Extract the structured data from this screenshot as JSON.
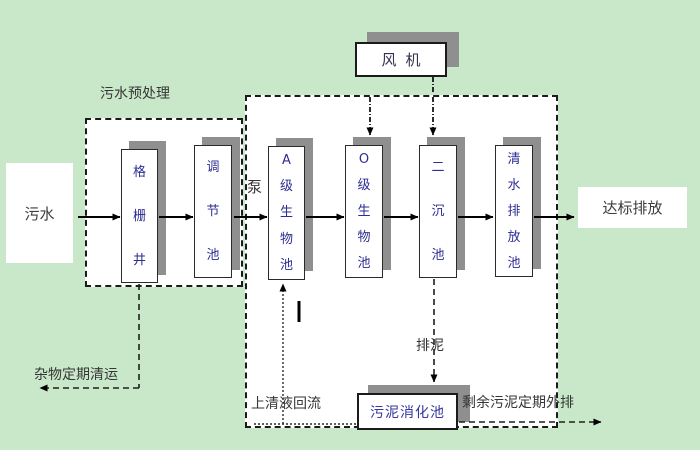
{
  "diagram_title_area": {
    "pretreat_section_label": "污水预处理"
  },
  "labels": {
    "influent": "污水",
    "effluent": "达标排放",
    "blower": "风机",
    "pump": "泵",
    "waste_removal": "杂物定期清运",
    "supernatant_return": "上清液回流",
    "sludge_discharge": "排泥",
    "excess_sludge_out": "剩余污泥定期外排",
    "digester": "污泥消化池"
  },
  "tanks": [
    {
      "label": "格栅井"
    },
    {
      "label": "调节池"
    },
    {
      "label": "A级生物池"
    },
    {
      "label": "O级生物池"
    },
    {
      "label": "二沉池"
    },
    {
      "label": "清水排放池"
    }
  ],
  "colors": {
    "background": "#c9e8c9",
    "panel_fill": "#ffffff",
    "box_shadow": "#8f8f8f",
    "tank_text": "#2d2d94",
    "digester_text": "#3636a0",
    "label_text": "#363636",
    "line": "#000000"
  }
}
